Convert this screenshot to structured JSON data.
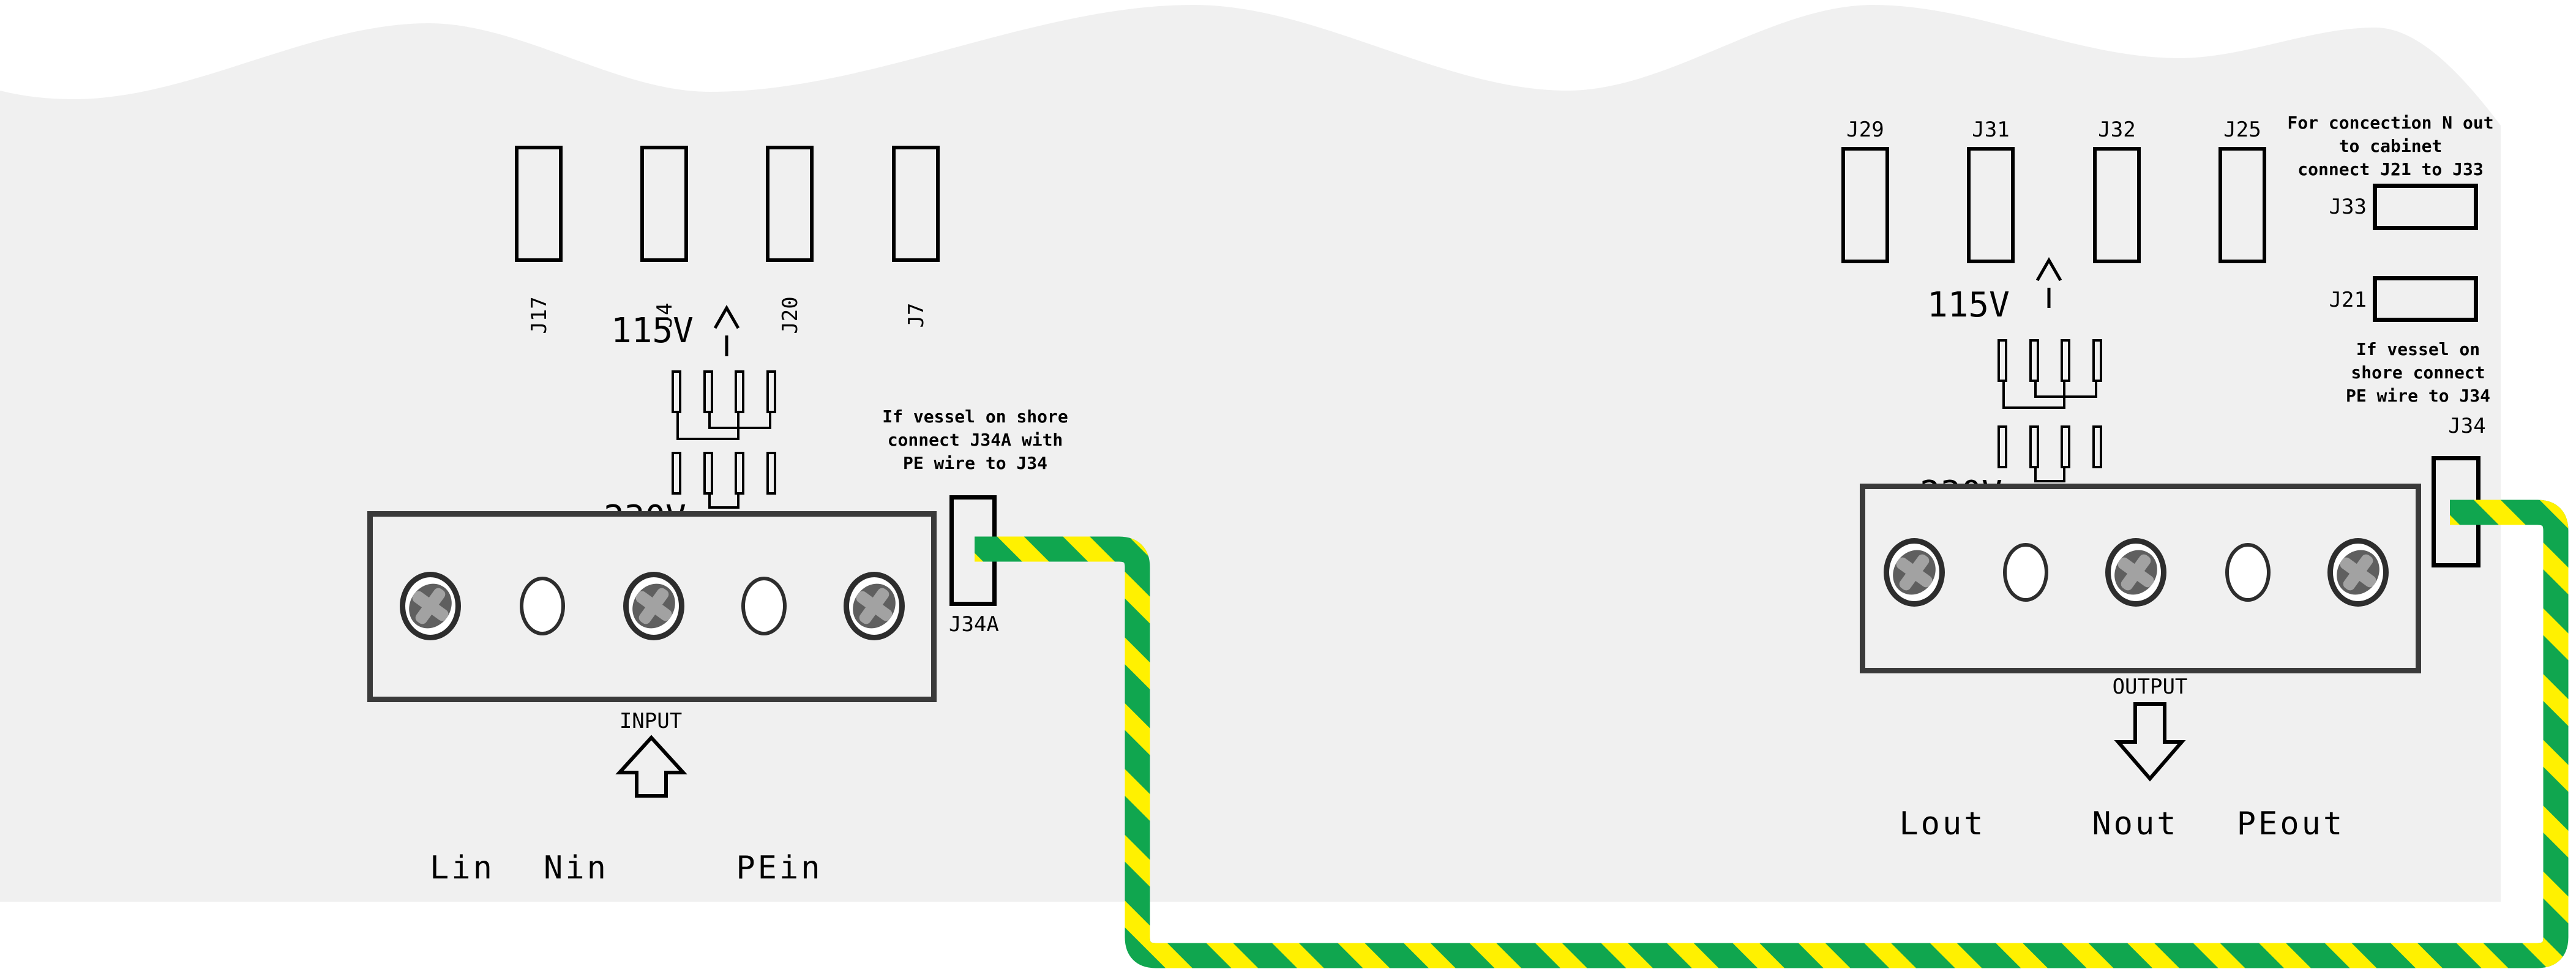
{
  "colors": {
    "page_bg": "#ffffff",
    "panel_bg": "#f0f0f0",
    "line": "#000000",
    "block_border": "#3a3a3a",
    "wire_green": "#10a64f",
    "wire_yellow": "#fff100"
  },
  "left": {
    "connectors": [
      {
        "label": "J17"
      },
      {
        "label": "J4"
      },
      {
        "label": "J20"
      },
      {
        "label": "J7"
      }
    ],
    "voltage_115": "115V",
    "voltage_230": "230V",
    "shore_note": {
      "line1": "If vessel on shore",
      "line2": "connect J34A with",
      "line3": "PE wire to J34"
    },
    "terminal_block_label": "INPUT",
    "terminal_labels": [
      "Lin",
      "Nin",
      "PEin"
    ],
    "pe_connector_label": "J34A"
  },
  "right": {
    "connectors": [
      {
        "label": "J29"
      },
      {
        "label": "J31"
      },
      {
        "label": "J32"
      },
      {
        "label": "J25"
      }
    ],
    "voltage_115": "115V",
    "voltage_230": "230V",
    "cabinet_note": {
      "line1": "For concection N out",
      "line2": "to cabinet",
      "line3": "connect J21 to J33"
    },
    "jumper_boxes": [
      {
        "label": "J33"
      },
      {
        "label": "J21"
      }
    ],
    "shore_note": {
      "line1": "If vessel on",
      "line2": "shore connect",
      "line3": "PE wire to J34"
    },
    "pe_connector_label": "J34",
    "terminal_block_label": "OUTPUT",
    "terminal_labels": [
      "Lout",
      "Nout",
      "PEout"
    ]
  }
}
